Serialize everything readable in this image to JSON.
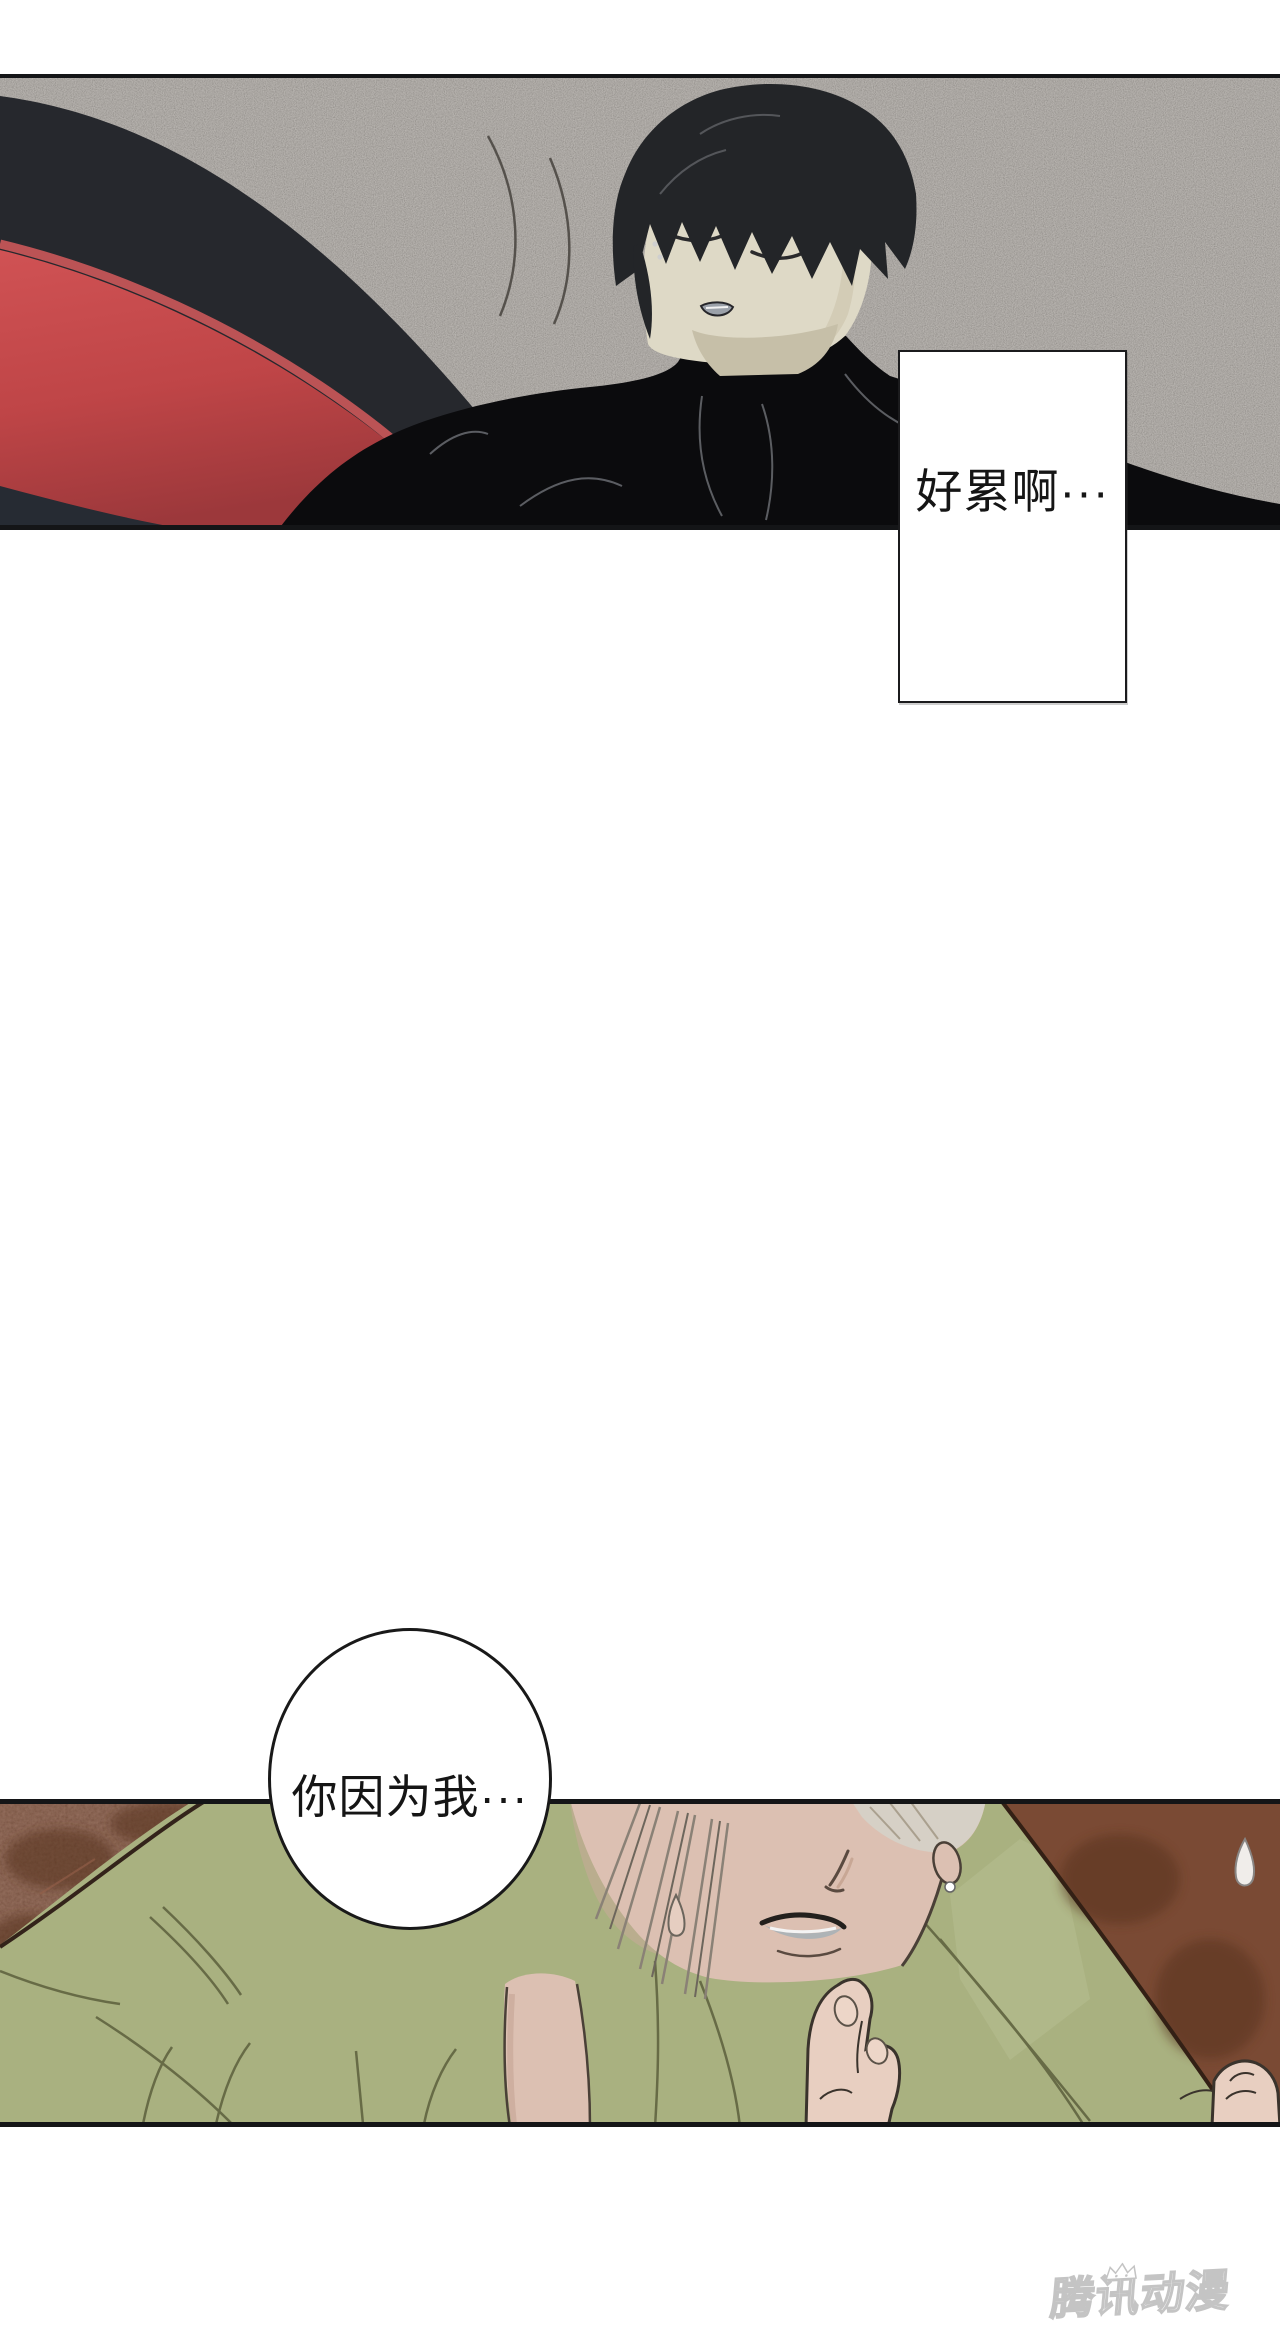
{
  "page": {
    "width": 1280,
    "height": 2345,
    "background": "#ffffff"
  },
  "panel_top": {
    "description": "dark-haired man in black sweater lying against red bench on asphalt",
    "dialog_box_text": "好累啊···",
    "colors": {
      "asphalt": "#9d968e",
      "bench_back": "#26282d",
      "bench_red": "#c04648",
      "bench_red_highlight": "#d25a5d",
      "bench_red_shadow": "#9c383b",
      "bench_base_shadow": "#262b33",
      "body_black": "#0b0b0d",
      "skin": "#ded9c6",
      "hair": "#232528",
      "panel_border": "#141517"
    }
  },
  "panel_bottom": {
    "description": "close-up of silver-haired man in olive shirt with raised hand, sweating",
    "speech_bubble_text": "你因为我···",
    "colors": {
      "background_brown": "#7a4a34",
      "background_brown_dark": "#57301e",
      "shirt_green": "#a9b180",
      "shirt_green_light": "#b6bd8f",
      "shirt_fold": "#676b46",
      "skin": "#dcc0b2",
      "hair_silver": "#d6d0c6",
      "mouth_interior": "#aeb3b6",
      "panel_border": "#141517"
    }
  },
  "watermark": {
    "text": "腾讯动漫",
    "fill": "#ffffff",
    "outline": "#bdbdbd"
  }
}
